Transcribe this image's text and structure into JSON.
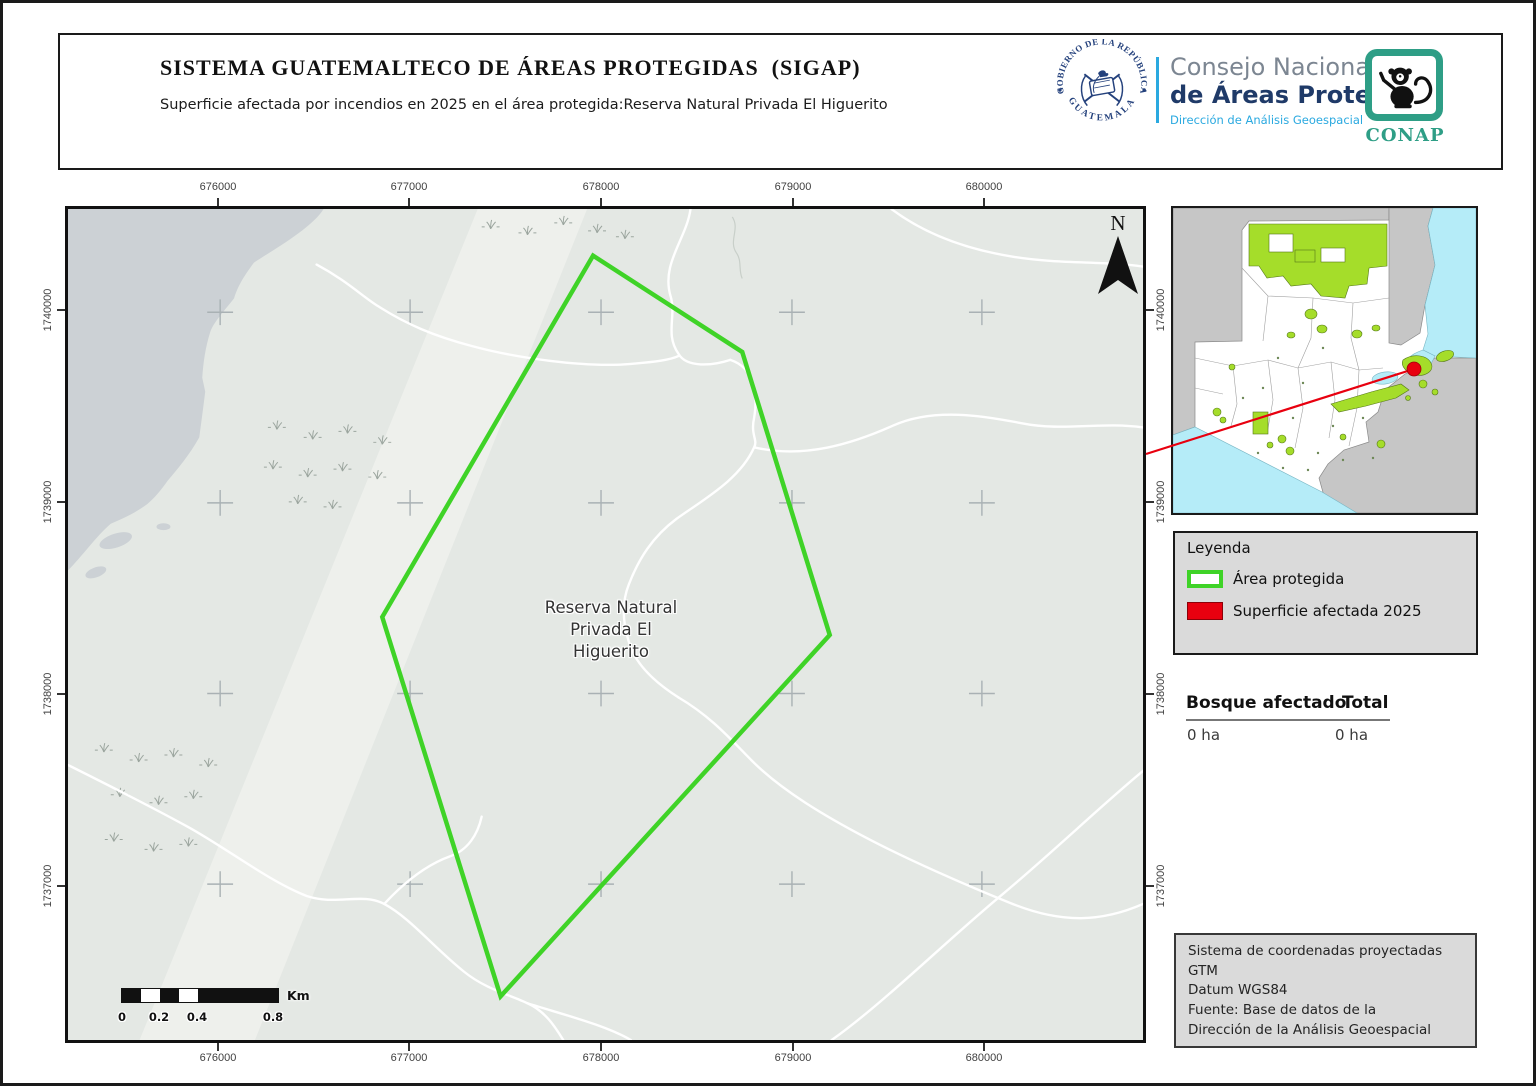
{
  "header": {
    "title": "SISTEMA GUATEMALTECO DE ÁREAS PROTEGIDAS  (SIGAP)",
    "subtitle": "Superficie afectada por incendios en 2025 en el área protegida:Reserva Natural Privada El Higuerito",
    "seal": {
      "arc_top": "GOBIERNO DE LA REPÚBLICA",
      "arc_bottom": "GUATEMALA"
    },
    "org": {
      "line1": "Consejo Nacional",
      "line2": "de Áreas Protegidas",
      "line3": "Dirección de Análisis Geoespacial"
    },
    "conap": "CONAP"
  },
  "map": {
    "x_ticks": [
      "676000",
      "677000",
      "678000",
      "679000",
      "680000"
    ],
    "y_ticks": [
      "1740000",
      "1739000",
      "1738000",
      "1737000"
    ],
    "north": "N",
    "area_label": [
      "Reserva Natural",
      "Privada El",
      "Higuerito"
    ],
    "scalebar": {
      "ticks": [
        "0",
        "0.2",
        "0.4",
        "0.8"
      ],
      "unit": "Km"
    }
  },
  "legend": {
    "title": "Leyenda",
    "items": [
      {
        "label": "Área protegida",
        "style": "green-outline"
      },
      {
        "label": "Superficie afectada 2025",
        "style": "red-fill"
      }
    ]
  },
  "stats": {
    "headers": [
      "Bosque afectado",
      "Total"
    ],
    "values": [
      "0 ha",
      "0 ha"
    ]
  },
  "info_box": {
    "lines": [
      "Sistema de coordenadas proyectadas",
      "GTM",
      "Datum WGS84",
      "Fuente: Base de datos de la",
      "Dirección de la Análisis Geoespacial"
    ]
  },
  "colors": {
    "protected_area_green": "#3fd327",
    "affected_red": "#e8000f",
    "inset_protected_green": "#a5dd2a",
    "water_cyan": "#b5ecf8",
    "conap_green": "#2e9e86",
    "navy": "#1f3a68",
    "accent_blue": "#2aa9e0"
  }
}
